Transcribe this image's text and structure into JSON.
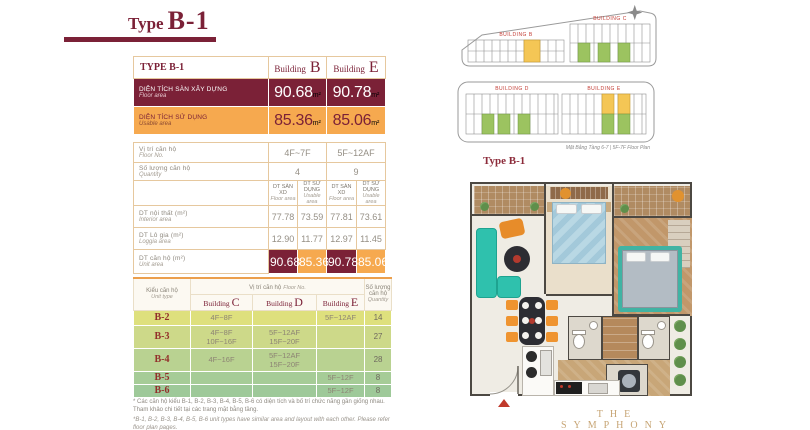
{
  "title": {
    "prefix": "Type",
    "code": "B-1"
  },
  "colors": {
    "maroon": "#7B2137",
    "orange": "#F6A94F",
    "gold": "#C7A575"
  },
  "main_table": {
    "corner": "TYPE B-1",
    "unit_suffix": "m²",
    "buildings": [
      {
        "label": "Building",
        "letter": "B"
      },
      {
        "label": "Building",
        "letter": "E"
      }
    ],
    "floor_area": {
      "vi": "DIỆN TÍCH SÀN XÂY DỰNG",
      "en": "Floor area",
      "values": [
        "90.68",
        "90.78"
      ]
    },
    "usable_area": {
      "vi": "DIỆN TÍCH SỬ DỤNG",
      "en": "Usable area",
      "values": [
        "85.36",
        "85.06"
      ]
    },
    "floor_no": {
      "vi": "Vị trí căn hộ",
      "en": "Floor No.",
      "values": [
        "4F~7F",
        "5F~12AF"
      ]
    },
    "quantity": {
      "vi": "Số lượng căn hộ",
      "en": "Quantity",
      "values": [
        "4",
        "9"
      ]
    },
    "subheaders": [
      {
        "vi": "DT SÀN XD",
        "en": "Floor area"
      },
      {
        "vi": "DT SỬ DỤNG",
        "en": "Usable area"
      },
      {
        "vi": "DT SÀN XD",
        "en": "Floor area"
      },
      {
        "vi": "DT SỬ DỤNG",
        "en": "Usable area"
      }
    ],
    "interior": {
      "vi": "DT nội thất (m²)",
      "en": "Interior area",
      "values": [
        "77.78",
        "73.59",
        "77.81",
        "73.61"
      ]
    },
    "loggia": {
      "vi": "DT Lô gia (m²)",
      "en": "Loggia area",
      "values": [
        "12.90",
        "11.77",
        "12.97",
        "11.45"
      ]
    },
    "unit_area": {
      "vi": "DT căn hộ (m²)",
      "en": "Unit area",
      "values": [
        "90.68",
        "85.36",
        "90.78",
        "85.06"
      ]
    }
  },
  "unit_table": {
    "unit_type": {
      "vi": "Kiểu căn hộ",
      "en": "Unit type"
    },
    "floor_no": {
      "vi": "Vị trí căn hộ",
      "en": "Floor No."
    },
    "quantity": {
      "vi": "Số lượng căn hộ",
      "en": "Quantity"
    },
    "buildings": [
      {
        "label": "Building",
        "letter": "C"
      },
      {
        "label": "Building",
        "letter": "D"
      },
      {
        "label": "Building",
        "letter": "E"
      }
    ],
    "rows": [
      {
        "type": "B-2",
        "c": "4F~8F",
        "d": "",
        "e": "5F~12AF",
        "qty": "14"
      },
      {
        "type": "B-3",
        "c": "4F~8F\n10F~16F",
        "d": "5F~12AF\n15F~20F",
        "e": "",
        "qty": "27"
      },
      {
        "type": "B-4",
        "c": "4F~16F",
        "d": "5F~12AF\n15F~20F",
        "e": "",
        "qty": "28"
      },
      {
        "type": "B-5",
        "c": "",
        "d": "",
        "e": "5F~12F",
        "qty": "8"
      },
      {
        "type": "B-6",
        "c": "",
        "d": "",
        "e": "5F~12F",
        "qty": "8"
      }
    ]
  },
  "footnotes": {
    "vi": "* Các căn hộ kiểu B-1, B-2, B-3, B-4, B-5, B-6 có diện tích và bố trí chức năng gần giống nhau. Tham khảo chi tiết tại các trang mặt bằng tầng.",
    "en": "*B-1, B-2, B-3, B-4, B-5, B-6 unit types have similar area and layout with each other. Please refer floor plan pages."
  },
  "site_plans": {
    "plan_top": {
      "left_label": "BUILDING B",
      "right_label": "BUILDING C"
    },
    "plan_bottom": {
      "left_label": "BUILDING D",
      "right_label": "BUILDING E",
      "caption": "Mặt Bằng Tầng 6-7 | 5F-7F Floor Plan"
    },
    "label": "Type B-1"
  },
  "brand": "THE SYMPHONY"
}
